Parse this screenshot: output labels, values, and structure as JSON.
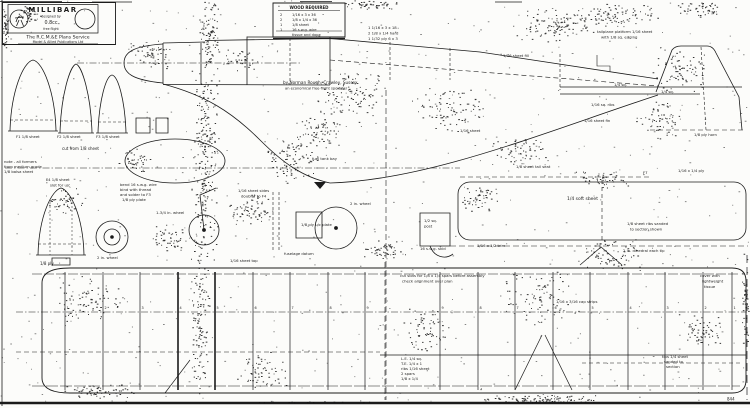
{
  "colors": {
    "ink": "#1b1b1b",
    "paper": "#fcfcfa"
  },
  "title_block": {
    "title": "MILLIBAR",
    "sub_line1": "designed by",
    "engine": "0.8cc",
    "sub_line2": "free flight",
    "service": "The R.C.M.&E Plans Service",
    "address": "Model & Allied Publications Ltd"
  },
  "materials_table": {
    "header": "WOOD REQUIRED",
    "rows": [
      [
        "2",
        "1/16 x 3 x 36"
      ],
      [
        "2",
        "1/8 x 1/4 x 36"
      ],
      [
        "1",
        "1/8 sheet"
      ],
      [
        "1",
        "16 s.w.g. wire"
      ]
    ],
    "footer": "tissue and dope"
  },
  "plan_number": "844",
  "wing": {
    "rib_stations": [
      65,
      103,
      140,
      178,
      215,
      253,
      290,
      328,
      365,
      440,
      478,
      515,
      553,
      590,
      628,
      665,
      703,
      732
    ],
    "rib_labels": [
      "1",
      "2",
      "3",
      "4",
      "5",
      "6",
      "7",
      "8",
      "9",
      "9",
      "8",
      "7",
      "6",
      "5",
      "4",
      "3",
      "2",
      "1"
    ]
  },
  "annotations": [
    [
      368,
      29,
      3.8,
      "1   1/16 x 3 x 18"
    ],
    [
      368,
      34.5,
      3.8,
      "2   1/8 x 1/4 hard"
    ],
    [
      368,
      40,
      3.8,
      "1   1/32 ply 6 x 3"
    ],
    [
      597,
      33,
      3.8,
      "tailplane platform 1/16 sheet"
    ],
    [
      601,
      38.5,
      3.8,
      "with 1/8 sq. edging"
    ],
    [
      503,
      57,
      3.8,
      "1/16 sheet fill"
    ],
    [
      283,
      84,
      4.2,
      "by Norman Rough, Crawley, Sussex"
    ],
    [
      285,
      89.5,
      3.6,
      "an economical free-flight sportster"
    ],
    [
      614,
      86,
      3.8,
      "1/4 sq."
    ],
    [
      661,
      93,
      3.8,
      "1/4 sq."
    ],
    [
      591,
      106,
      3.8,
      "1/16 sq. ribs"
    ],
    [
      584,
      122,
      3.8,
      "1/16 sheet fin"
    ],
    [
      694,
      136,
      3.8,
      "1/8 ply horn"
    ],
    [
      460,
      132,
      3.8,
      "1/16 sheet"
    ],
    [
      516,
      168,
      3.8,
      "1/8 sheet tail seat"
    ],
    [
      643,
      174,
      3.8,
      "F7"
    ],
    [
      678,
      172,
      3.8,
      "1/16 x 1/4 ply"
    ],
    [
      567,
      200,
      4.5,
      "1/4 soft sheet"
    ],
    [
      627,
      225,
      3.8,
      "1/8 sheet ribs sanded"
    ],
    [
      630,
      230.5,
      3.8,
      "to section shown"
    ],
    [
      477,
      247,
      3.8,
      "1/16 x 1/2 trim"
    ],
    [
      120,
      186,
      3.8,
      "bend 16 s.w.g. wire"
    ],
    [
      120,
      191,
      3.8,
      "bind with thread"
    ],
    [
      120,
      196,
      3.8,
      "and solder to F3"
    ],
    [
      122,
      201,
      3.8,
      "1/8 ply plate"
    ],
    [
      156,
      214,
      3.8,
      "1-3/4 in. wheel"
    ],
    [
      238,
      192,
      3.8,
      "1/16 sheet sides"
    ],
    [
      241,
      197.5,
      3.8,
      "doubler to F4"
    ],
    [
      301,
      226,
      3.8,
      "1/8 ply u/c plate"
    ],
    [
      312,
      160,
      3.8,
      "fuel tank bay"
    ],
    [
      350,
      205,
      3.8,
      "2 in. wheel"
    ],
    [
      424,
      222,
      3.8,
      "1/2 sq."
    ],
    [
      424,
      227.5,
      3.8,
      "post"
    ],
    [
      420,
      250,
      3.8,
      "16 s.w.g. skid"
    ],
    [
      16,
      138,
      3.8,
      "F1 1/8 sheet"
    ],
    [
      57,
      138,
      3.8,
      "F2 1/8 sheet"
    ],
    [
      96,
      138,
      3.8,
      "F3 1/8 sheet"
    ],
    [
      62,
      150,
      4,
      "cut from 1/8 sheet"
    ],
    [
      4,
      163,
      3.8,
      "note - all formers"
    ],
    [
      4,
      168,
      3.8,
      "from medium grade"
    ],
    [
      4,
      173,
      3.8,
      "1/8 balsa sheet"
    ],
    [
      46,
      181,
      3.8,
      "F4 1/8 sheet"
    ],
    [
      50,
      186.5,
      3.8,
      "slot for u/c"
    ],
    [
      40,
      265,
      4,
      "1/8 ply"
    ],
    [
      97,
      259,
      3.8,
      "2 in. wheel"
    ],
    [
      230,
      262,
      3.8,
      "1/16 sheet top"
    ],
    [
      400,
      277,
      3.8,
      "cut slots for 1/8 x 1/4 spars before assembly"
    ],
    [
      402,
      282.5,
      3.8,
      "check alignment over plan"
    ],
    [
      700,
      277,
      3.8,
      "cover with"
    ],
    [
      702,
      282.5,
      3.8,
      "lightweight"
    ],
    [
      704,
      288,
      3.8,
      "tissue"
    ],
    [
      556,
      303,
      3.8,
      "1/16 x 3/16 cap strips"
    ],
    [
      401,
      360,
      3.8,
      "L.E. 1/4 sq."
    ],
    [
      401,
      365,
      3.8,
      "T.E. 1/4 x 1"
    ],
    [
      401,
      370,
      3.8,
      "ribs 1/16 sheet"
    ],
    [
      401,
      375,
      3.8,
      "2 spars"
    ],
    [
      401,
      380,
      3.8,
      "1/8 x 1/4"
    ],
    [
      662,
      358,
      3.8,
      "tips 1/4 sheet"
    ],
    [
      664,
      363,
      3.8,
      "sanded to"
    ],
    [
      666,
      368,
      3.8,
      "section"
    ],
    [
      623,
      252,
      3.8,
      "2 in. dihedral each tip"
    ],
    [
      284,
      255,
      3.8,
      "fuselage datum"
    ]
  ]
}
